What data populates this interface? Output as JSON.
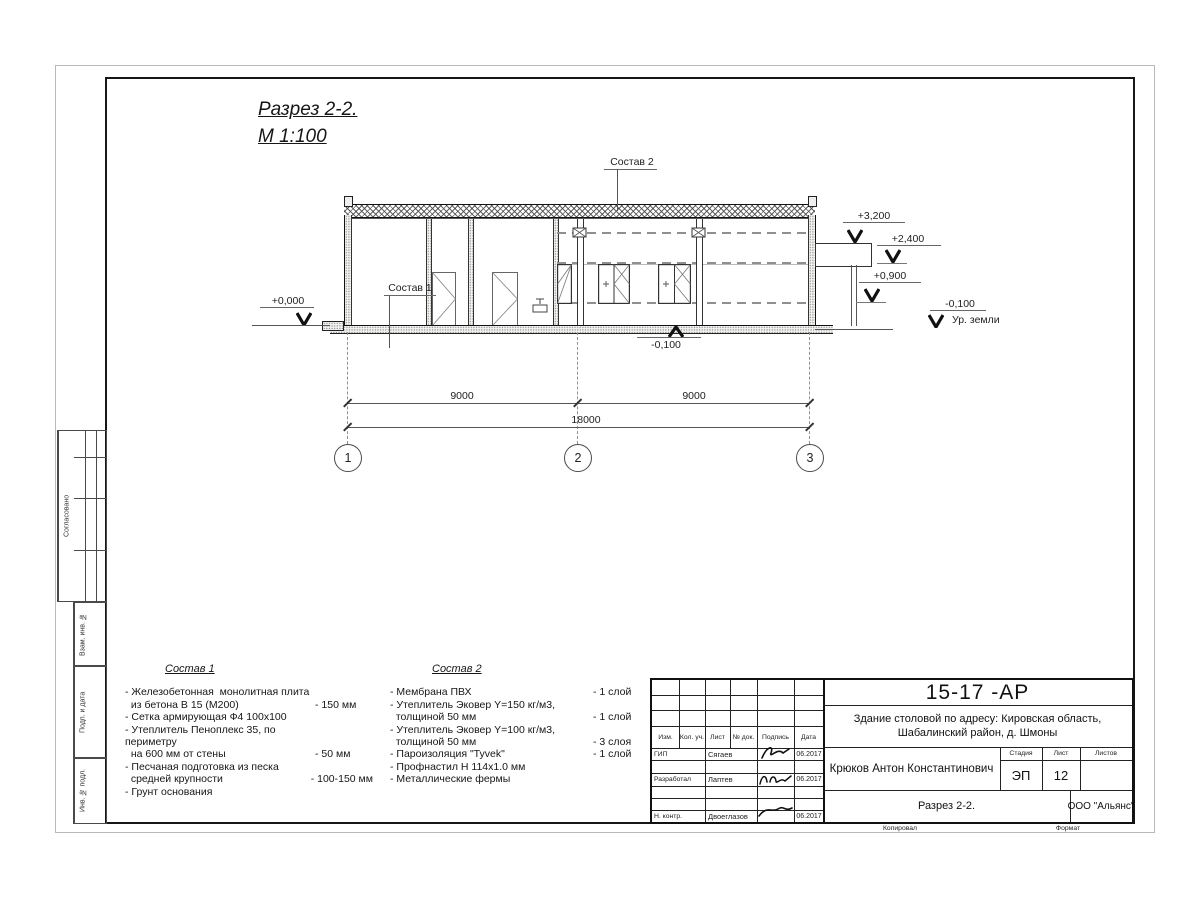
{
  "drawing": {
    "title_line1": "Разрез 2-2.",
    "title_line2": "М 1:100",
    "callout1": "Состав 1",
    "callout2": "Состав 2",
    "lev_3200": "+3,200",
    "lev_2400": "+2,400",
    "lev_0900": "+0,900",
    "lev_0000": "+0,000",
    "lev_m0100_center": "-0,100",
    "lev_m0100_right": "-0,100",
    "ground_label": "Ур. земли",
    "dim_left": "9000",
    "dim_right": "9000",
    "dim_total": "18000",
    "axis_1": "1",
    "axis_2": "2",
    "axis_3": "3"
  },
  "sostav1": {
    "title": "Состав 1",
    "items": [
      {
        "text": "- Железобетонная  монолитная плита\n  из бетона В 15 (М200)",
        "value": "- 150 мм"
      },
      {
        "text": "- Сетка армирующая Ф4 100х100",
        "value": ""
      },
      {
        "text": "- Утеплитель Пеноплекс 35, по периметру\n  на 600 мм от стены",
        "value": "- 50 мм"
      },
      {
        "text": "- Песчаная подготовка из песка\n  средней крупности",
        "value": "- 100-150 мм"
      },
      {
        "text": "- Грунт основания",
        "value": ""
      }
    ]
  },
  "sostav2": {
    "title": "Состав 2",
    "items": [
      {
        "text": "- Мембрана ПВХ",
        "value": "- 1 слой"
      },
      {
        "text": "- Утеплитель Эковер Y=150 кг/м3,\n  толщиной 50 мм",
        "value": "- 1 слой"
      },
      {
        "text": "- Утеплитель Эковер Y=100 кг/м3,\n  толщиной 50 мм",
        "value": "- 3 слоя"
      },
      {
        "text": "- Пароизоляция \"Tyvek\"",
        "value": "- 1 слой"
      },
      {
        "text": "- Профнастил Н 114х1.0 мм",
        "value": ""
      },
      {
        "text": "- Металлические фермы",
        "value": ""
      }
    ]
  },
  "titleblock": {
    "doc_number": "15-17 -АР",
    "object_line1": "Здание столовой по адресу: Кировская область,",
    "object_line2": "Шабалинский район, д. Шмоны",
    "cols": [
      "Изм.",
      "Кол. уч.",
      "Лист",
      "№ док.",
      "Подпись",
      "Дата"
    ],
    "sign_rows": [
      {
        "role": "ГИП",
        "name": "Сягаев",
        "date": "06.2017"
      },
      {
        "role": "Разработал",
        "name": "Лаптев",
        "date": "06.2017"
      },
      {
        "role": "Н. контр.",
        "name": "Двоеглазов",
        "date": "06.2017"
      }
    ],
    "author": "Крюков Антон Константинович",
    "stage_label": "Стадия",
    "sheet_label": "Лист",
    "sheets_label": "Листов",
    "stage": "ЭП",
    "sheet_no": "12",
    "section_name": "Разрез 2-2.",
    "company": "ООО \"Альянс\"",
    "copied_label": "Копировал",
    "format_label": "Формат"
  },
  "side_labels": {
    "approve": "Согласовано",
    "vzam": "Взам. инв. №",
    "podp": "Подп. и дата",
    "inv": "Инв. № подл."
  }
}
